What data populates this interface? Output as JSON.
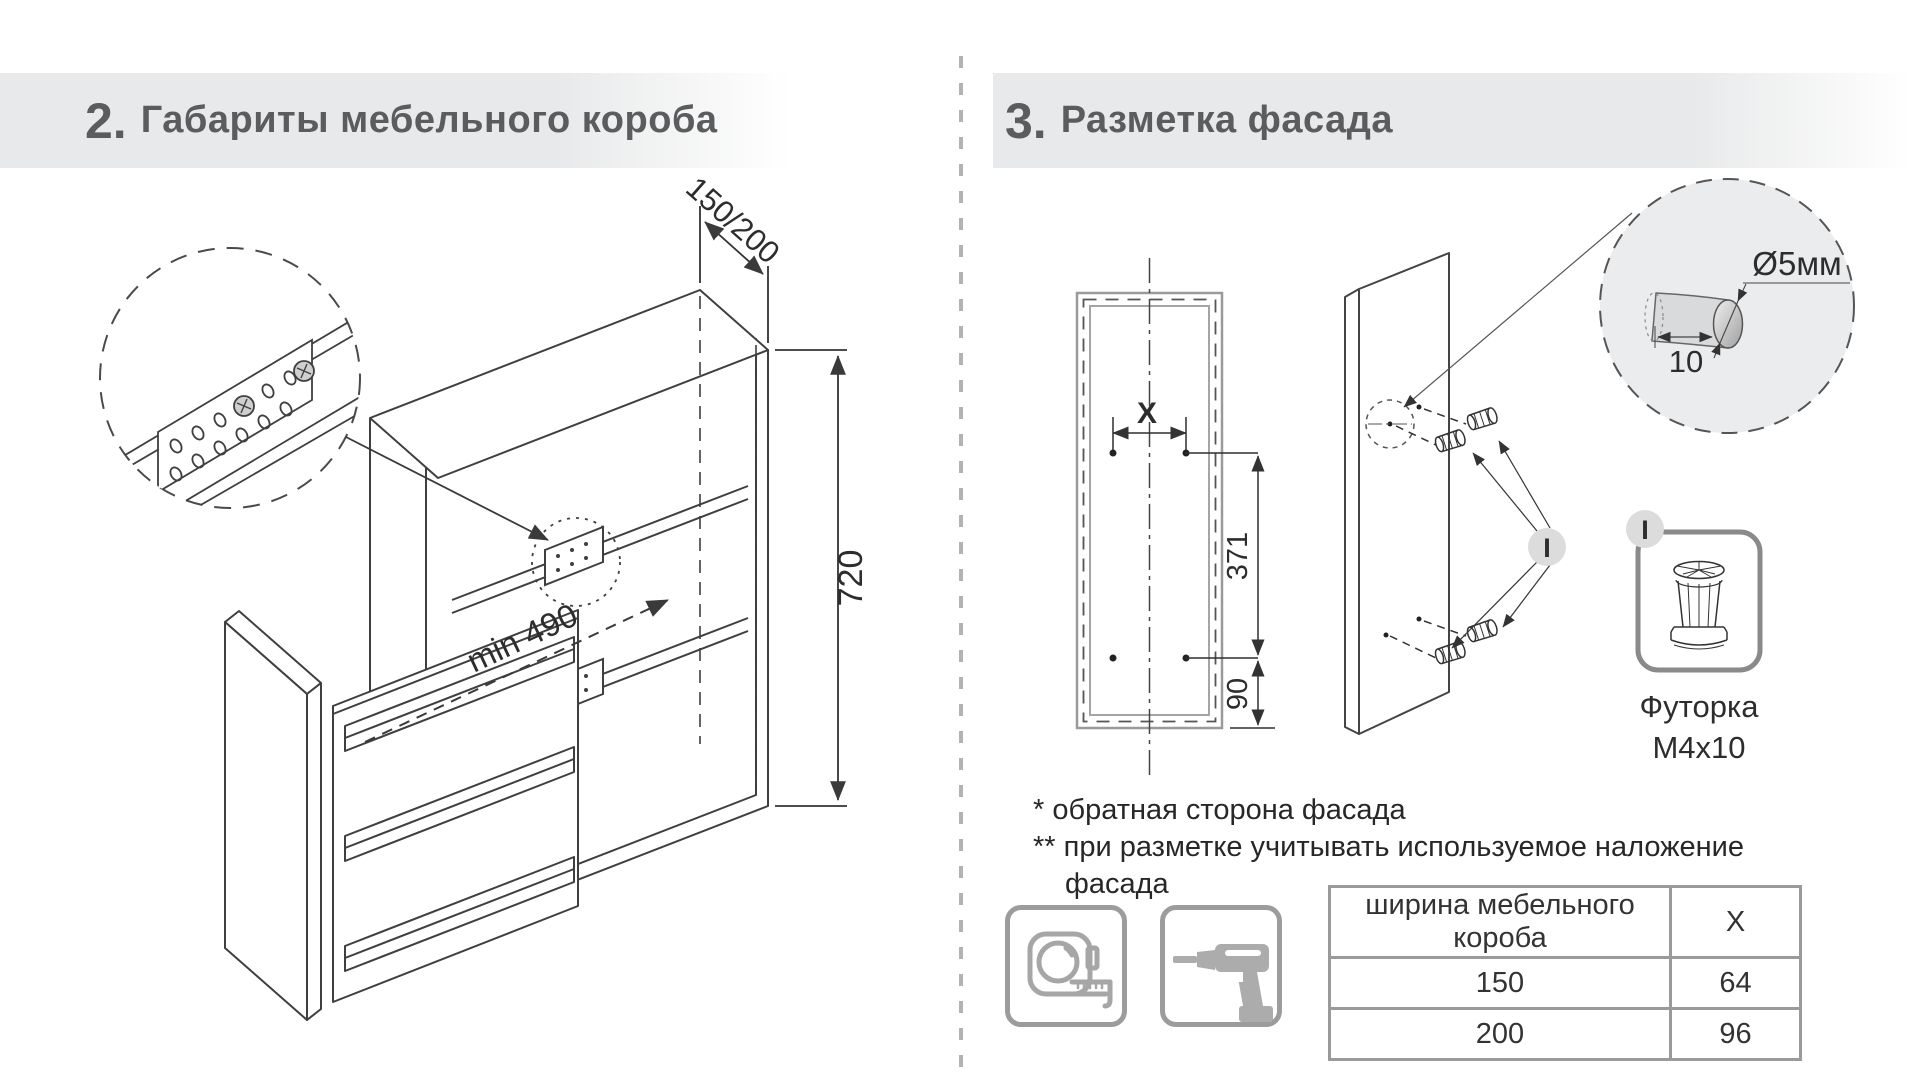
{
  "sections": {
    "left": {
      "number": "2.",
      "title": "Габариты мебельного короба"
    },
    "right": {
      "number": "3.",
      "title": "Разметка фасада"
    }
  },
  "cabinet": {
    "width_dim": "150/200",
    "height_dim": "720",
    "depth_dim": "min 490"
  },
  "facade": {
    "x_dim": "X",
    "upper_dim": "371",
    "lower_dim": "90"
  },
  "hole": {
    "diameter": "Ø5мм",
    "depth": "10"
  },
  "callout": {
    "label": "I"
  },
  "part": {
    "callout": "I",
    "name": "Футорка",
    "size": "M4x10"
  },
  "footnotes": {
    "first": "* обратная сторона фасада",
    "second": "** при разметке учитывать используемое наложение",
    "third": "фасада"
  },
  "table": {
    "col1": "ширина мебельного короба",
    "col2": "X",
    "rows": [
      {
        "w": "150",
        "x": "64"
      },
      {
        "w": "200",
        "x": "96"
      }
    ]
  },
  "icons": {
    "tools": [
      "tape-measure-icon",
      "drill-icon"
    ]
  },
  "colors": {
    "band": "#e8e9ea",
    "title_text": "#5b5c5e",
    "line": "#3f3f3f",
    "gray_border": "#9a9a9a",
    "detail_fill": "#ebeced"
  }
}
